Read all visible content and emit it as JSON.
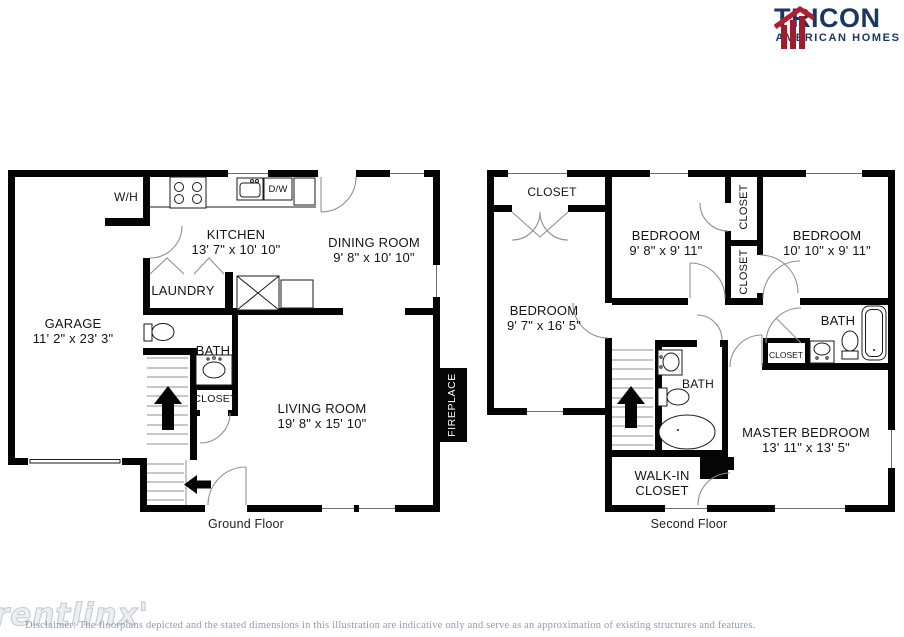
{
  "logo": {
    "name": "TRICON",
    "subname": "AMERICAN HOMES",
    "red": "#B31F2E",
    "navy": "#1C3664"
  },
  "ground": {
    "caption": "Ground Floor",
    "rooms": {
      "garage": {
        "name": "GARAGE",
        "dims": "11' 2\" x 23' 3\""
      },
      "kitchen": {
        "name": "KITCHEN",
        "dims": "13' 7\" x 10' 10\""
      },
      "dining": {
        "name": "DINING ROOM",
        "dims": "9' 8\" x 10' 10\""
      },
      "living": {
        "name": "LIVING ROOM",
        "dims": "19' 8\" x 15' 10\""
      },
      "laundry": {
        "name": "LAUNDRY"
      },
      "bath": {
        "name": "BATH"
      },
      "closet": {
        "name": "CLOSET"
      },
      "wh": {
        "name": "W/H"
      },
      "dw": {
        "name": "D/W"
      },
      "fireplace": {
        "name": "FIREPLACE"
      }
    }
  },
  "second": {
    "caption": "Second Floor",
    "rooms": {
      "closet_top": {
        "name": "CLOSET"
      },
      "bedroom_left": {
        "name": "BEDROOM",
        "dims": "9' 7\" x 16' 5\""
      },
      "bedroom_mid": {
        "name": "BEDROOM",
        "dims": "9' 8\" x 9' 11\""
      },
      "bedroom_right": {
        "name": "BEDROOM",
        "dims": "10' 10\" x 9' 11\""
      },
      "closet_upper": {
        "name": "CLOSET"
      },
      "closet_lower": {
        "name": "CLOSET"
      },
      "closet_hall": {
        "name": "CLOSET"
      },
      "bath_right": {
        "name": "BATH"
      },
      "bath_mid": {
        "name": "BATH"
      },
      "master": {
        "name": "MASTER BEDROOM",
        "dims": "13' 11\" x 13' 5\""
      },
      "walkin_line1": {
        "name": "WALK-IN"
      },
      "walkin_line2": {
        "name": "CLOSET"
      }
    }
  },
  "footer": {
    "watermark": "rentlinx'",
    "disclaimer": "Disclaimer: The floorplans depicted and the stated dimensions in this illustration are indicative only and serve as an approximation of existing structures and features."
  }
}
